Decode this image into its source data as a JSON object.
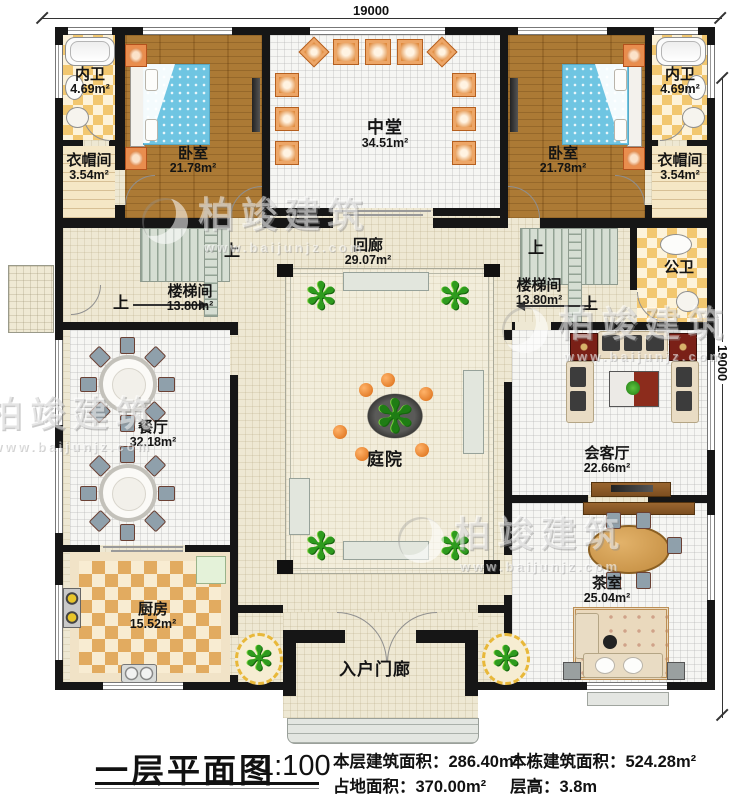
{
  "dimensions": {
    "top": "19000",
    "right": "19000"
  },
  "watermark": {
    "brand": "柏竣建筑",
    "url": "www.baijunjz.com"
  },
  "plan": {
    "up": "上"
  },
  "icons": {
    "plant": "✻"
  },
  "rooms": {
    "bath_left": {
      "name": "内卫",
      "area": "4.69m²"
    },
    "cloak_left": {
      "name": "衣帽间",
      "area": "3.54m²"
    },
    "bedroom_left": {
      "name": "卧室",
      "area": "21.78m²"
    },
    "hall": {
      "name": "中堂",
      "area": "34.51m²"
    },
    "bedroom_right": {
      "name": "卧室",
      "area": "21.78m²"
    },
    "bath_right": {
      "name": "内卫",
      "area": "4.69m²"
    },
    "cloak_right": {
      "name": "衣帽间",
      "area": "3.54m²"
    },
    "corridor": {
      "name": "回廊",
      "area": "29.07m²"
    },
    "stair_left": {
      "name": "楼梯间",
      "area": "13.80m²"
    },
    "stair_right": {
      "name": "楼梯间",
      "area": "13.80m²"
    },
    "public_bath": {
      "name": "公卫"
    },
    "dining": {
      "name": "餐厅",
      "area": "32.18m²"
    },
    "courtyard": {
      "name": "庭院"
    },
    "reception": {
      "name": "会客厅",
      "area": "22.66m²"
    },
    "kitchen": {
      "name": "厨房",
      "area": "15.52m²"
    },
    "tea": {
      "name": "茶室",
      "area": "25.04m²"
    },
    "porch": {
      "name": "入户门廊"
    }
  },
  "caption": {
    "title": "一层平面图",
    "scale": "1:100",
    "stats": [
      {
        "label": "本层建筑面积：",
        "value": "286.40m²"
      },
      {
        "label": "占地面积：",
        "value": "370.00m²"
      },
      {
        "label": "本栋建筑面积：",
        "value": "524.28m²"
      },
      {
        "label": "层高：",
        "value": "3.8m"
      }
    ]
  }
}
